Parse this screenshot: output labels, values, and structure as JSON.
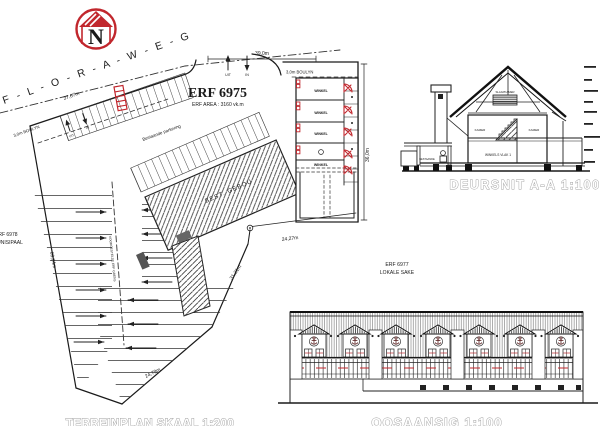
{
  "north_arrow": {
    "letter": "N"
  },
  "street": {
    "name": "F - L - O - R - A - W - E - G"
  },
  "site_plan": {
    "erf_number": "ERF 6975",
    "erf_area": "ERF AREA : 3160 vk.m",
    "existing_parking_note": "Bestaande parkering",
    "existing_building_label": "BEST. GEBOU",
    "building_line_top": "3,0m  BOULYN",
    "building_line_left": "3,0m  BOULYN",
    "exit_label": "UIT",
    "entry_label": "IN",
    "exit_label_2": "UIT",
    "entry_label_2": "IN",
    "neighbor_erf_number": "ERF 6978",
    "neighbor_erf_name": "MUNISIPAAL",
    "proposed_boundary_label": "VOORGESTELDE ERF GRENS",
    "shop_unit_label": "WINKEL",
    "dim_frontage_top": "39,0m",
    "dim_street_edge": "37,67m",
    "dim_right_side": "36,0m",
    "dim_left_side": "63,04m",
    "dim_hall_width": "24,27m",
    "dim_bottom_left": "24,79m",
    "dim_bottom_right": "31,21m",
    "caption": "TERREINPLAN  SKAAL 1:200"
  },
  "section_drawing": {
    "caption": "DEURSNIT A-A  1:100",
    "attic_room_label": "SLAAPKAMER",
    "room_left_label": "KAMER",
    "room_right_label": "KAMER",
    "ground_floor_label": "WINKELS  VLAK 1",
    "porch_label": "BESTAANDE"
  },
  "elevation_drawing": {
    "erf_number": "ERF 6977",
    "land_use_label": "LOKALE SAKE",
    "caption": "OOSAANSIG  1:100"
  },
  "colors": {
    "accent_red": "#c1272d",
    "line_ink": "#1a1a1a",
    "ghost_caption": "#9e9e9e"
  }
}
